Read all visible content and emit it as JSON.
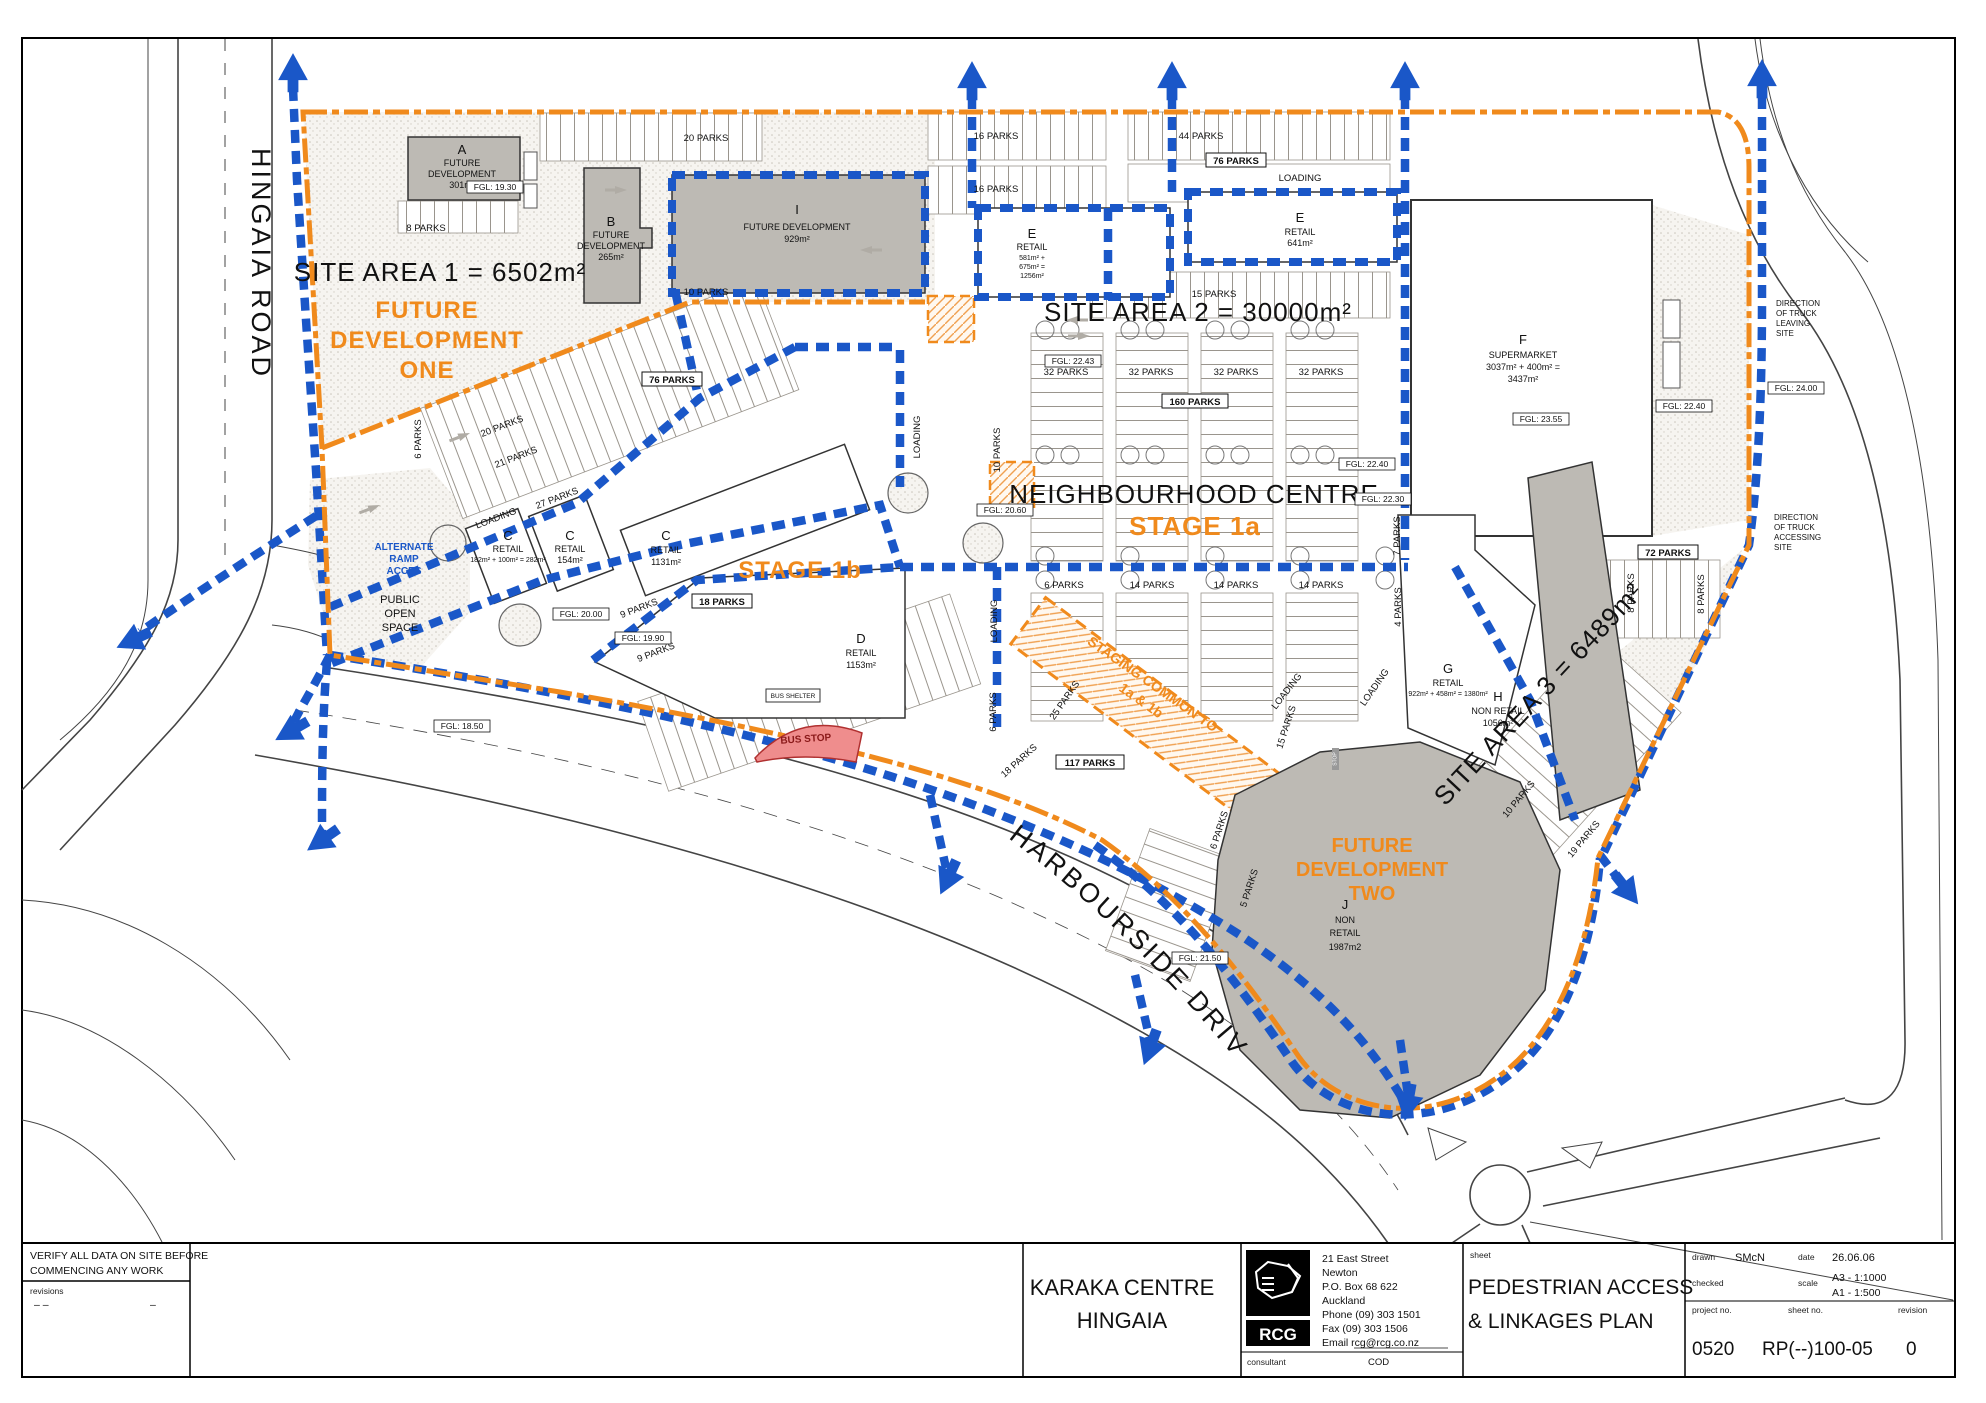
{
  "title_block": {
    "notes": {
      "line1": "VERIFY ALL DATA ON SITE BEFORE",
      "line2": "COMMENCING ANY WORK",
      "revisions_label": "revisions",
      "dash_a": "–      –",
      "dash_b": "–"
    },
    "project": {
      "line1": "KARAKA CENTRE",
      "line2": "HINGAIA"
    },
    "firm": {
      "logo_text": "RCG",
      "address1": "21 East Street",
      "address2": "Newton",
      "address3": "P.O. Box 68 622",
      "address4": "Auckland",
      "address5": "Phone (09) 303 1501",
      "address6": "Fax    (09) 303 1506",
      "address7": "Email  rcg@rcg.co.nz",
      "consultant_label": "consultant",
      "consultant_value": "COD"
    },
    "sheet": {
      "label": "sheet",
      "title1": "PEDESTRIAN ACCESS",
      "title2": "& LINKAGES PLAN"
    },
    "details": {
      "drawn_label": "drawn",
      "drawn": "SMcN",
      "date_label": "date",
      "date": "26.06.06",
      "checked_label": "checked",
      "scale_label": "scale",
      "scale1": "A3 - 1:1000",
      "scale2": "A1 - 1:500",
      "project_no_label": "project no.",
      "project_no": "0520",
      "sheet_no_label": "sheet no.",
      "sheet_no": "RP(--)100-05",
      "revision_label": "revision",
      "revision": "0"
    }
  },
  "plan": {
    "roads": {
      "hingaia": "HINGAIA ROAD",
      "harbourside": "HARBOURSIDE DRIVE"
    },
    "areas": {
      "site1": "SITE AREA 1 = 6502m²",
      "site2": "SITE AREA 2 = 30000m²",
      "site3": "SITE AREA 3 = 6489m²",
      "future_one": [
        "FUTURE",
        "DEVELOPMENT",
        "ONE"
      ],
      "future_two": [
        "FUTURE",
        "DEVELOPMENT",
        "TWO"
      ],
      "centre": "NEIGHBOURHOOD CENTRE",
      "stage1a": "STAGE 1a",
      "stage1b": "STAGE 1b",
      "staging1": "STAGING COMMON TO",
      "staging2": "1a & 1b",
      "pos": [
        "PUBLIC",
        "OPEN",
        "SPACE"
      ],
      "ramp": [
        "ALTERNATE",
        "RAMP",
        "ACCES"
      ]
    },
    "buildings": {
      "a": [
        "A",
        "FUTURE",
        "DEVELOPMENT",
        "301m²"
      ],
      "b": [
        "B",
        "FUTURE",
        "DEVELOPMENT",
        "265m²"
      ],
      "i": [
        "I",
        "FUTURE DEVELOPMENT",
        "929m²"
      ],
      "e1": [
        "E",
        "RETAIL",
        "581m² +",
        "675m² =",
        "1256m²"
      ],
      "e2": [
        "E",
        "RETAIL",
        "641m²"
      ],
      "f": [
        "F",
        "SUPERMARKET",
        "3037m² + 400m² =",
        "3437m²"
      ],
      "c1": [
        "C",
        "RETAIL",
        "182m² + 100m² = 282m²"
      ],
      "c2": [
        "C",
        "RETAIL",
        "154m²"
      ],
      "c3": [
        "C",
        "RETAIL",
        "1131m²"
      ],
      "d": [
        "D",
        "RETAIL",
        "1153m²"
      ],
      "g": [
        "G",
        "RETAIL",
        "922m² + 458m² = 1380m²"
      ],
      "h": [
        "H",
        "NON RETAIL",
        "1056m²"
      ],
      "j": [
        "J",
        "NON",
        "RETAIL",
        "1987m2"
      ]
    },
    "parking": [
      "8 PARKS",
      "20 PARKS",
      "10 PARKS",
      "16 PARKS",
      "16 PARKS",
      "44 PARKS",
      "76 PARKS",
      "LOADING",
      "15 PARKS",
      "32 PARKS",
      "32 PARKS",
      "32 PARKS",
      "32 PARKS",
      "160 PARKS",
      "76 PARKS",
      "20 PARKS",
      "21 PARKS",
      "27 PARKS",
      "LOADING",
      "10 PARKS",
      "LOADING",
      "6 PARKS",
      "14 PARKS",
      "14 PARKS",
      "14 PARKS",
      "7 PARKS",
      "4 PARKS",
      "18 PARKS",
      "9 PARKS",
      "9 PARKS",
      "18 PARKS",
      "25 PARKS",
      "117 PARKS",
      "15 PARKS",
      "6 PARKS",
      "LOADING",
      "6 PARKS",
      "LOADING",
      "LOADING",
      "72 PARKS",
      "8 PARKS",
      "8 PARKS",
      "10 PARKS",
      "19 PARKS",
      "5 PARKS",
      "6 PARKS"
    ],
    "fgl": [
      "FGL: 19.30",
      "FGL: 23.55",
      "FGL: 22.40",
      "FGL: 24.00",
      "FGL: 22.43",
      "FGL: 22.40",
      "FGL: 22.30",
      "FGL: 20.60",
      "FGL: 20.00",
      "FGL: 19.90",
      "FGL: 21.50",
      "FGL: 18.50"
    ],
    "notes": {
      "truck_leaving": [
        "DIRECTION",
        "OF TRUCK",
        "LEAVING",
        "SITE"
      ],
      "truck_access": [
        "DIRECTION",
        "OF TRUCK",
        "ACCESSING",
        "SITE"
      ],
      "bus_stop": "BUS STOP",
      "bus_shelter": "BUS SHELTER",
      "stop": "STOP"
    }
  },
  "colors": {
    "path_blue": "#1a57c8",
    "boundary_orange": "#f08a1c",
    "building_grey": "#bdbab4",
    "bus_red": "#ef8d8d"
  }
}
